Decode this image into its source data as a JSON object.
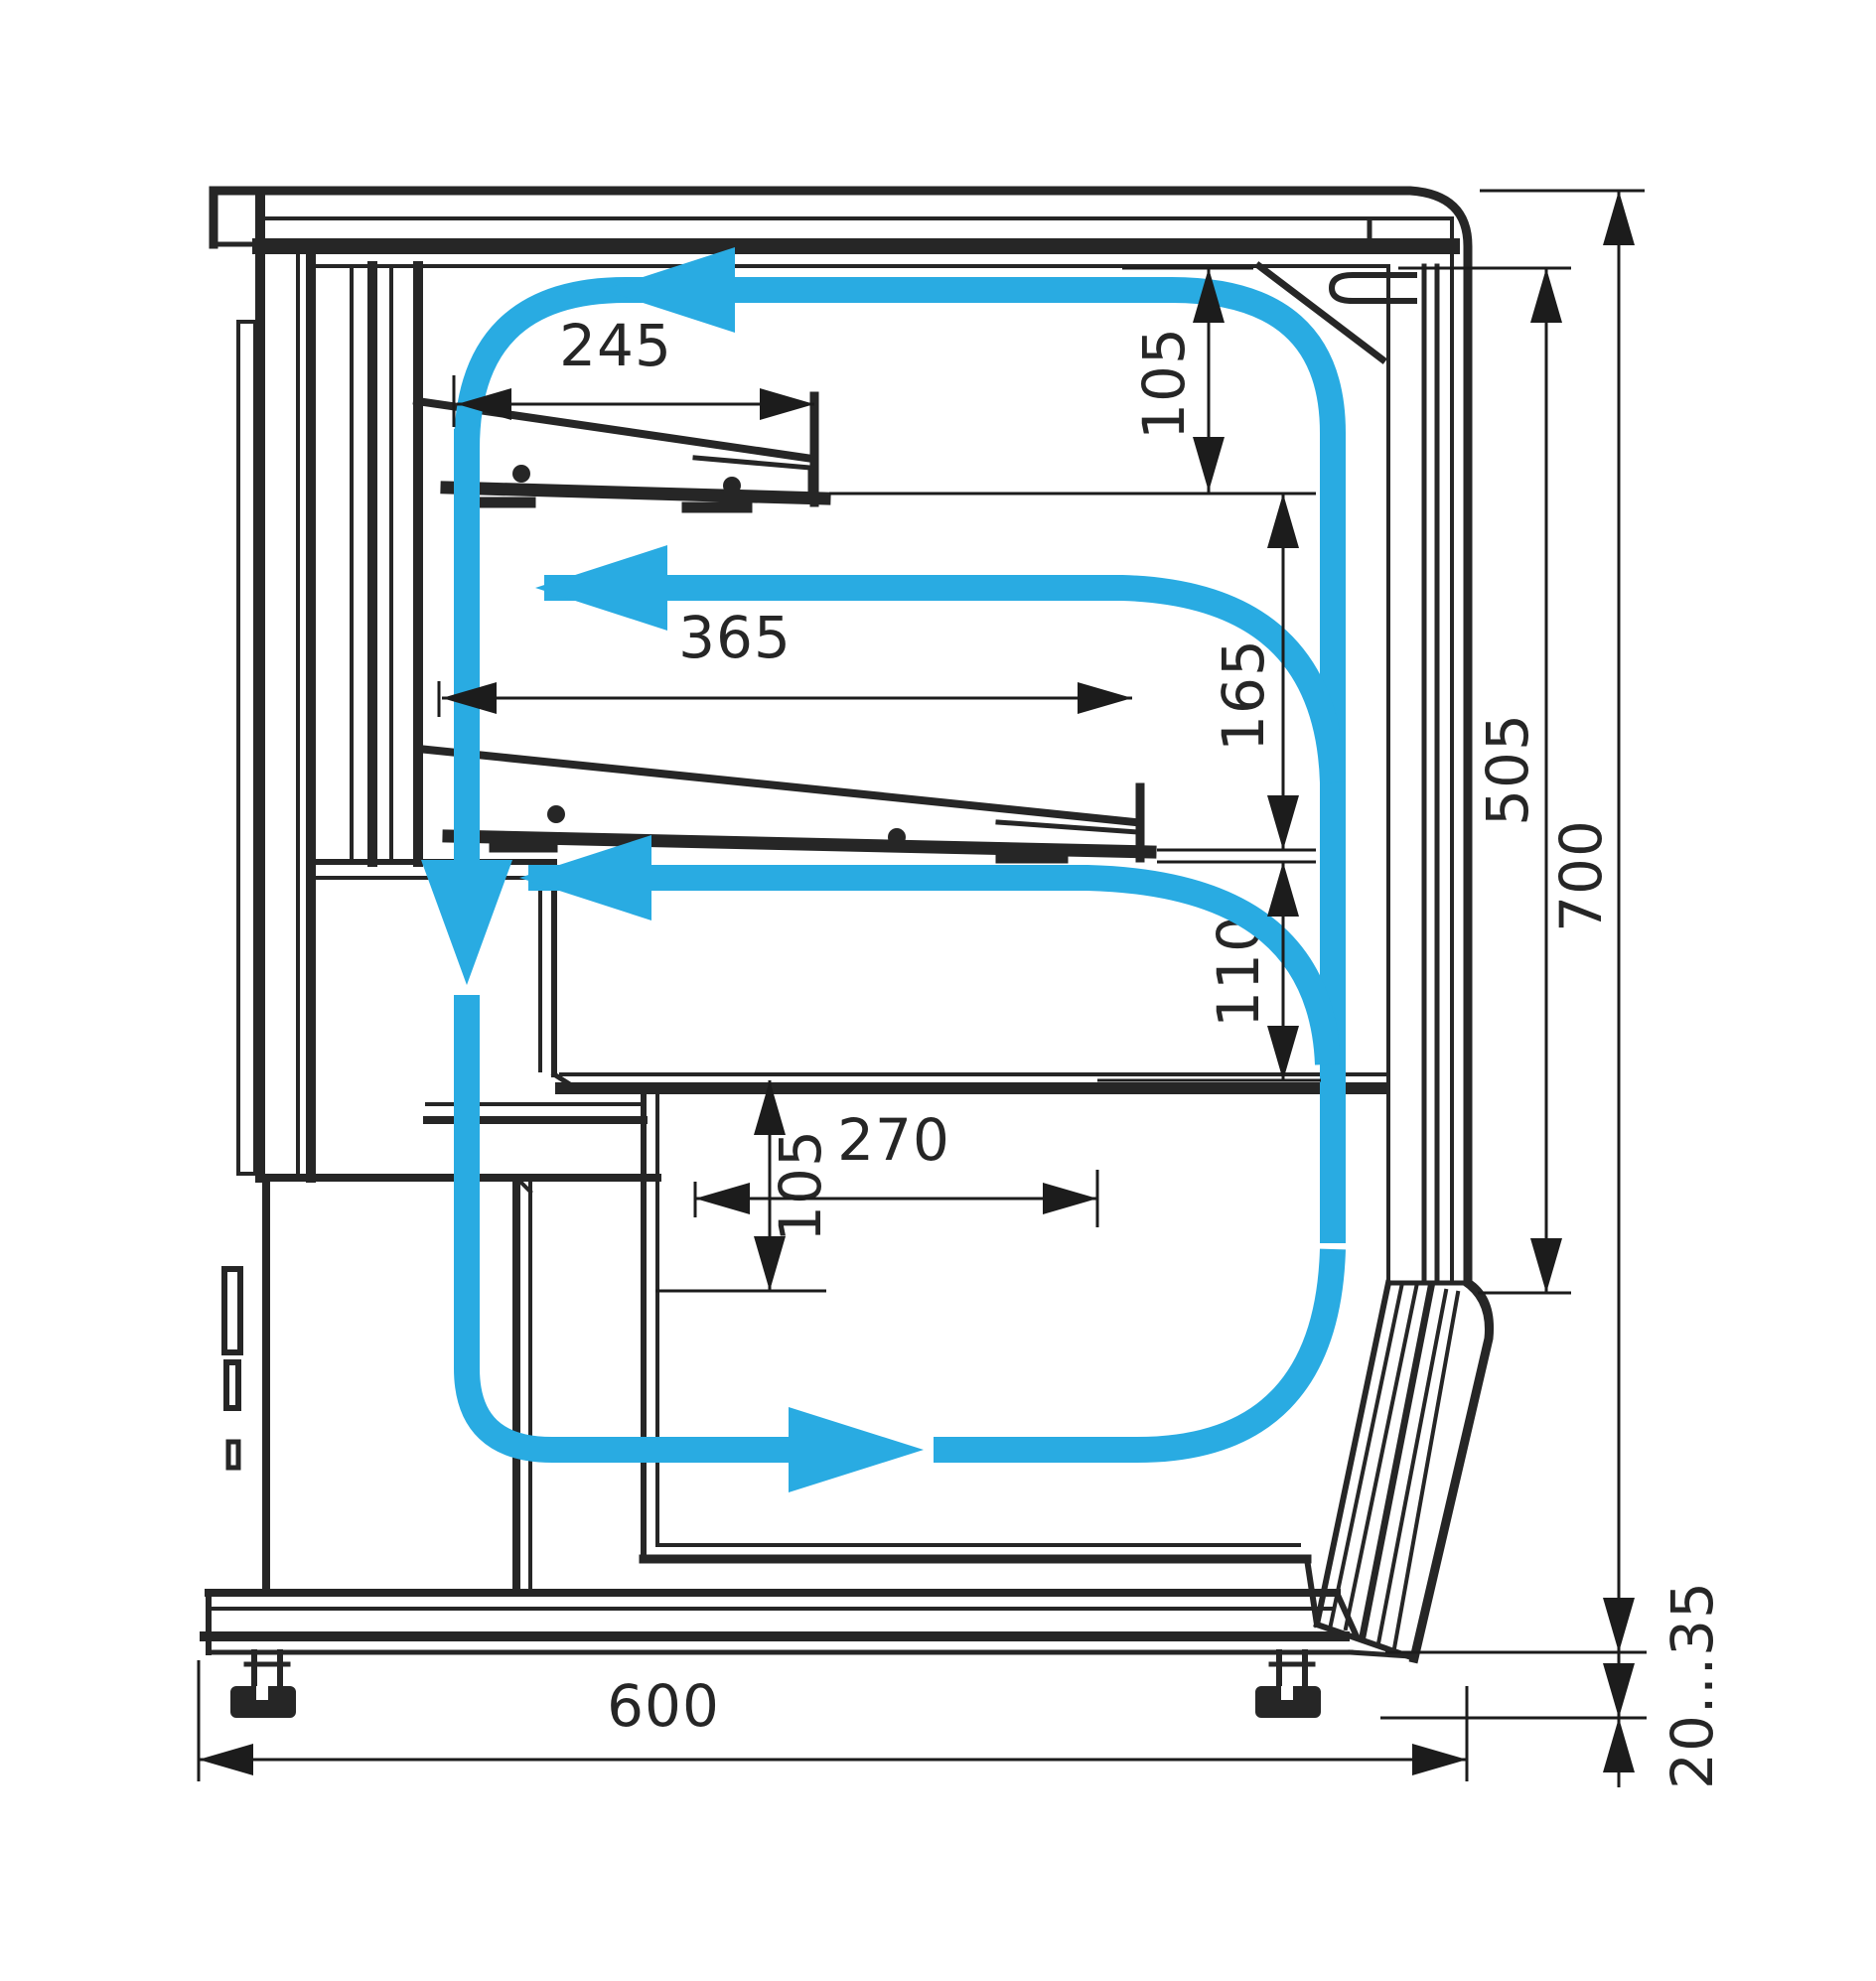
{
  "diagram": {
    "dimensions": {
      "upper_shelf_depth": "245",
      "upper_clearance": "105",
      "middle_shelf_depth": "365",
      "shelf_spacing": "165",
      "under_shelf_clearance": "110",
      "deck_depth": "270",
      "deck_front_height": "105",
      "overall_depth": "600",
      "display_opening_height": "505",
      "overall_height": "700",
      "foot_adjustment_range": "20...35"
    },
    "colors": {
      "line": "#262626",
      "airflow": "#29abe2",
      "background": "#ffffff"
    }
  }
}
